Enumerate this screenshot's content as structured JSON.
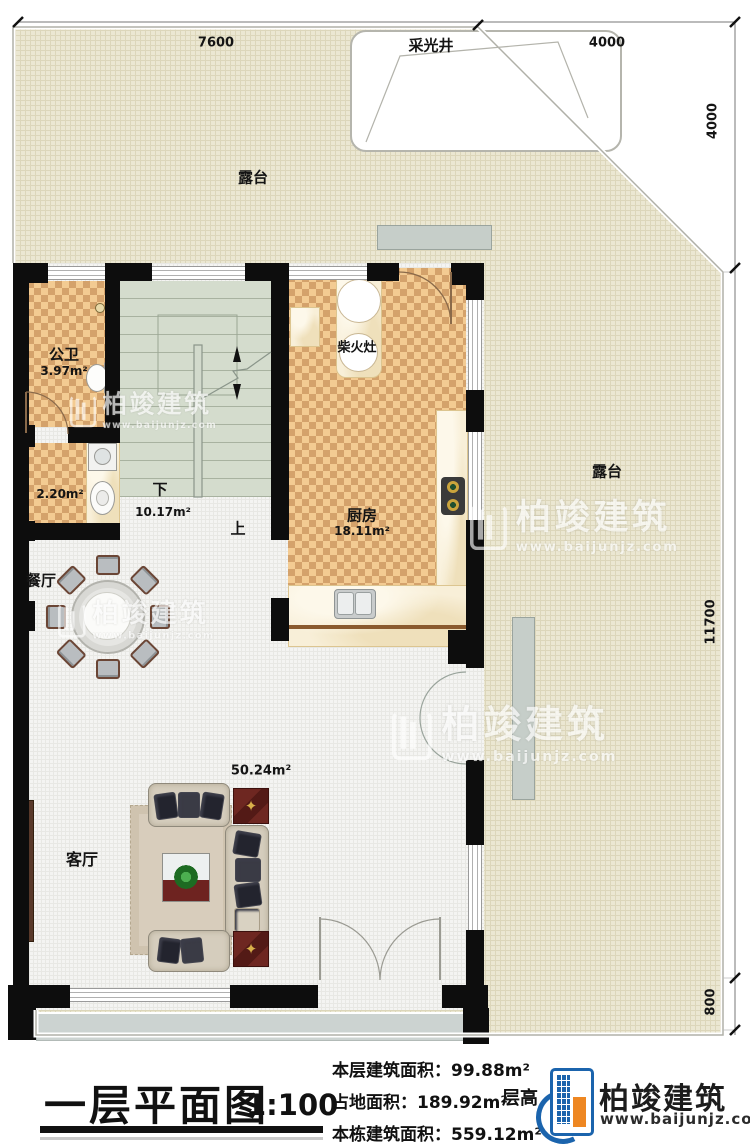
{
  "plan": {
    "dimensions": {
      "top_left": "7600",
      "top_right": "4000",
      "right_top": "4000",
      "right_middle": "11700",
      "right_bottom": "800"
    },
    "skylight": "采光井",
    "terrace_top": "露台",
    "terrace_right": "露台",
    "bathroom": {
      "name": "公卫",
      "area": "3.97m²"
    },
    "laundry": {
      "area": "2.20m²"
    },
    "stairs": {
      "down": "下",
      "area": "10.17m²",
      "up": "上"
    },
    "kitchen": {
      "name": "厨房",
      "area": "18.11m²",
      "stove": "柴火灶"
    },
    "dining": {
      "name": "餐厅"
    },
    "living": {
      "name": "客厅",
      "area": "50.24m²"
    }
  },
  "titleblock": {
    "title": "一层平面图",
    "scale": "1:100",
    "stats": [
      "本层建筑面积：99.88m²",
      "占地面积：189.92m²",
      "本栋建筑面积：559.12m²"
    ],
    "floor_height_prefix": "层高",
    "floor_height_value": "4.",
    "brand_name": "柏竣建筑",
    "brand_url": "www.baijunjz.com"
  },
  "watermark": {
    "name": "柏竣建筑",
    "url": "www.baijunjz.com"
  }
}
